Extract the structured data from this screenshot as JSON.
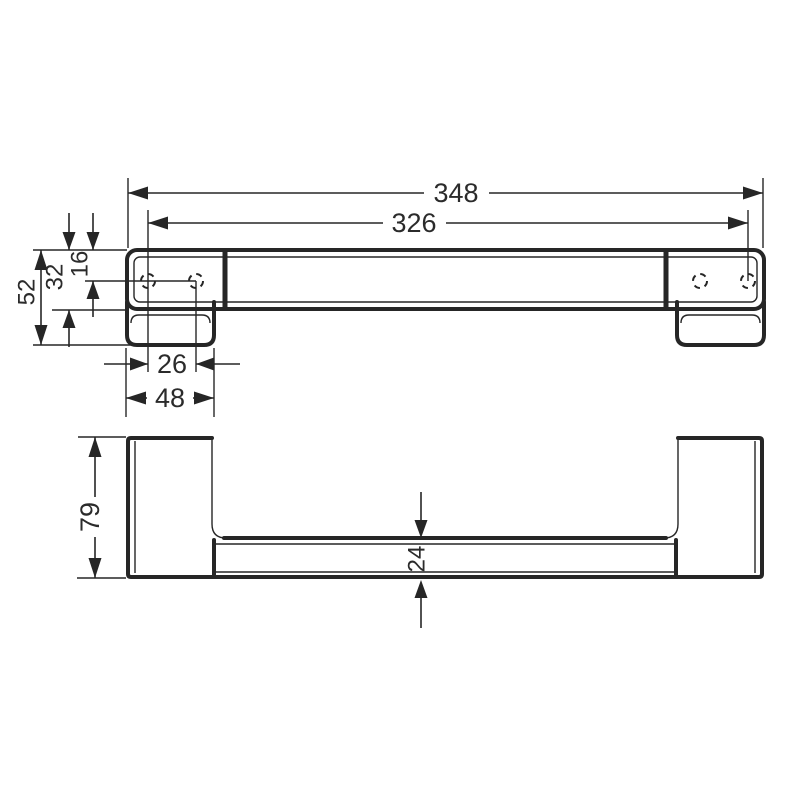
{
  "page": {
    "background_color": "#ffffff",
    "line_color": "#262626",
    "description": "Technical dimension drawing, two orthographic views of a wall-mounted grab bar"
  },
  "dims": {
    "overall_width": "348",
    "mounting_hole_span": "326",
    "end_height": "52",
    "bar_face_height": "32",
    "hole_offset_from_top": "16",
    "hole_pair_spacing": "26",
    "endcap_width": "48",
    "projection_depth": "79",
    "bar_thickness": "24"
  }
}
